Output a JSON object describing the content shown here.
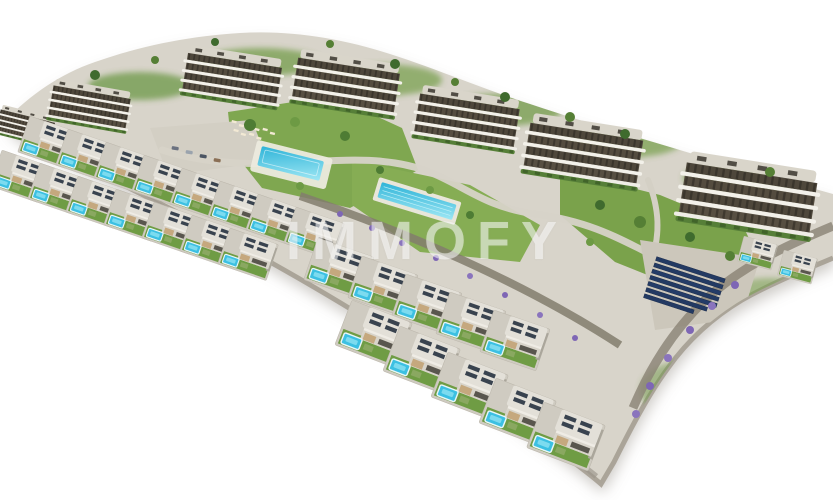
{
  "watermark": {
    "text": "IMMOFY"
  },
  "scene": {
    "type": "3d-architectural-aerial-render",
    "description": "Aerial 3D rendering of a hillside residential development on a crescent-shaped plot over a white background: six curved-balcony apartment blocks along the upper edge, staggered rows of detached white villas with private turquoise pools in the foreground, a communal pool with sun loungers, a lap pool, lawns, palm and purple flowering landscaping, stone retaining walls, a paved plaza with parked cars and a dark-blue rooftop solar panel array near the right side.",
    "counts": {
      "apartment_blocks": 6,
      "villas": 27,
      "communal_pools": 2,
      "solar_panel_rows": 7
    },
    "palette": {
      "background": "#ffffff",
      "ground": "#d8d4ca",
      "lawn": "#7aa24b",
      "pool_water": "#3cc0e2",
      "building_facade": "#f3f1ea",
      "glazing_band": "#4e473b",
      "solar_panels": "#233a63",
      "purple_shrubs": "#7e66b5",
      "stone_wall": "#8a8274",
      "watermark_color": "rgba(255,255,255,0.5)"
    }
  }
}
